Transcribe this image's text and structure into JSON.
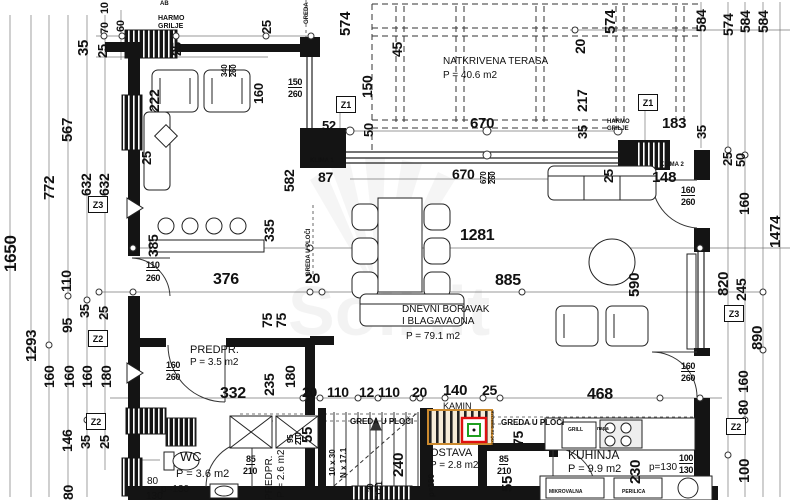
{
  "plan": {
    "title": "Ground floor plan",
    "watermark": "SolHit",
    "rooms": [
      {
        "name": "NATKRIVENA TERASA",
        "area": "P = 40.6 m2"
      },
      {
        "name": "DNEVNI BORAVAK I BLAGAVAONA",
        "area": "P = 79.1 m2"
      },
      {
        "name": "PREDPR.",
        "area": "P = 3.5 m2"
      },
      {
        "name": "WC",
        "area": "P = 3.6 m2"
      },
      {
        "name": "PREDPR.",
        "area": "P = 2.6 m2"
      },
      {
        "name": "OSTAVA",
        "area": "P = 2.8 m2"
      },
      {
        "name": "KUHINJA",
        "area": "P = 9.9 m2"
      }
    ],
    "markers": [
      {
        "t": "Z1",
        "x": 336,
        "y": 96
      },
      {
        "t": "Z1",
        "x": 638,
        "y": 94
      },
      {
        "t": "Z3",
        "x": 88,
        "y": 196
      },
      {
        "t": "Z2",
        "x": 88,
        "y": 330
      },
      {
        "t": "Z2",
        "x": 86,
        "y": 413
      },
      {
        "t": "Z3",
        "x": 724,
        "y": 305
      },
      {
        "t": "Z2",
        "x": 726,
        "y": 418
      }
    ],
    "labels": [
      {
        "t": "1650",
        "x": 2,
        "y": 272,
        "r": -90,
        "fs": 17
      },
      {
        "t": "1293",
        "x": 24,
        "y": 362,
        "r": -90,
        "fs": 15
      },
      {
        "t": "772",
        "x": 42,
        "y": 200,
        "r": -90,
        "fs": 15
      },
      {
        "t": "567",
        "x": 60,
        "y": 142,
        "r": -90,
        "fs": 15
      },
      {
        "t": "632",
        "x": 79,
        "y": 196,
        "r": -90,
        "fs": 14
      },
      {
        "t": "632",
        "x": 97,
        "y": 196,
        "r": -90,
        "fs": 14
      },
      {
        "t": "110",
        "x": 59,
        "y": 292,
        "r": -90,
        "fs": 14
      },
      {
        "t": "95",
        "x": 60,
        "y": 333,
        "r": -90,
        "fs": 14
      },
      {
        "t": "35",
        "x": 78,
        "y": 318,
        "r": -90,
        "fs": 13
      },
      {
        "t": "25",
        "x": 97,
        "y": 320,
        "r": -90,
        "fs": 13
      },
      {
        "t": "160",
        "x": 42,
        "y": 388,
        "r": -90,
        "fs": 14
      },
      {
        "t": "160",
        "x": 62,
        "y": 388,
        "r": -90,
        "fs": 14
      },
      {
        "t": "160",
        "x": 80,
        "y": 388,
        "r": -90,
        "fs": 14
      },
      {
        "t": "180",
        "x": 99,
        "y": 388,
        "r": -90,
        "fs": 14
      },
      {
        "t": "146",
        "x": 60,
        "y": 452,
        "r": -90,
        "fs": 14
      },
      {
        "t": "35",
        "x": 79,
        "y": 449,
        "r": -90,
        "fs": 13
      },
      {
        "t": "25",
        "x": 98,
        "y": 449,
        "r": -90,
        "fs": 13
      },
      {
        "t": "80",
        "x": 61,
        "y": 500,
        "r": -90,
        "fs": 14
      },
      {
        "t": "35",
        "x": 76,
        "y": 56,
        "r": -90,
        "fs": 15
      },
      {
        "t": "25",
        "x": 96,
        "y": 58,
        "r": -90,
        "fs": 13
      },
      {
        "t": "10",
        "x": 100,
        "y": 14,
        "r": -90,
        "fs": 11
      },
      {
        "t": "70",
        "x": 100,
        "y": 34,
        "r": -90,
        "fs": 11
      },
      {
        "t": "60",
        "x": 116,
        "y": 32,
        "r": -90,
        "fs": 11
      },
      {
        "t": "25",
        "x": 170,
        "y": 56,
        "r": -90,
        "fs": 13
      },
      {
        "t": "25",
        "x": 260,
        "y": 34,
        "r": -90,
        "fs": 13
      },
      {
        "t": "AB",
        "x": 160,
        "y": 1,
        "fs": 6,
        "c": "tiny"
      },
      {
        "t": "HARMO",
        "x": 158,
        "y": 15,
        "fs": 7,
        "c": "tiny"
      },
      {
        "t": "GRILJE",
        "x": 158,
        "y": 23,
        "fs": 7,
        "c": "tiny"
      },
      {
        "t": "GREDA",
        "x": 304,
        "y": 24,
        "r": -90,
        "fs": 6,
        "c": "tiny"
      },
      {
        "t": "574",
        "x": 338,
        "y": 36,
        "r": -90,
        "fs": 15
      },
      {
        "t": "45",
        "x": 390,
        "y": 57,
        "r": -90,
        "fs": 14
      },
      {
        "t": "150",
        "x": 360,
        "y": 98,
        "r": -90,
        "fs": 14
      },
      {
        "t": "50",
        "x": 362,
        "y": 137,
        "r": -90,
        "fs": 13
      },
      {
        "t": "150",
        "x": 288,
        "y": 78,
        "fs": 9,
        "c": "fracu"
      },
      {
        "t": "260",
        "x": 288,
        "y": 90,
        "fs": 9,
        "c": "frac"
      },
      {
        "t": "582",
        "x": 282,
        "y": 192,
        "r": -90,
        "fs": 14
      },
      {
        "t": "87",
        "x": 318,
        "y": 170,
        "fs": 14
      },
      {
        "t": "52",
        "x": 322,
        "y": 119,
        "fs": 13
      },
      {
        "t": "670",
        "x": 470,
        "y": 116,
        "fs": 15
      },
      {
        "t": "670",
        "x": 452,
        "y": 167,
        "fs": 14
      },
      {
        "t": "670",
        "x": 480,
        "y": 184,
        "r": -90,
        "fs": 8,
        "c": "fracu"
      },
      {
        "t": "260",
        "x": 489,
        "y": 184,
        "r": -90,
        "fs": 8,
        "c": "frac"
      },
      {
        "t": "KLIMA 1",
        "x": 310,
        "y": 158,
        "fs": 6,
        "c": "tiny"
      },
      {
        "t": "20",
        "x": 573,
        "y": 54,
        "r": -90,
        "fs": 14
      },
      {
        "t": "574",
        "x": 603,
        "y": 34,
        "r": -90,
        "fs": 15
      },
      {
        "t": "217",
        "x": 575,
        "y": 112,
        "r": -90,
        "fs": 14
      },
      {
        "t": "35",
        "x": 576,
        "y": 139,
        "r": -90,
        "fs": 13
      },
      {
        "t": "183",
        "x": 662,
        "y": 116,
        "fs": 15
      },
      {
        "t": "HARMO",
        "x": 607,
        "y": 119,
        "fs": 6,
        "c": "tiny"
      },
      {
        "t": "GRILJE",
        "x": 607,
        "y": 126,
        "fs": 6,
        "c": "tiny"
      },
      {
        "t": "35",
        "x": 695,
        "y": 139,
        "r": -90,
        "fs": 13
      },
      {
        "t": "584",
        "x": 694,
        "y": 32,
        "r": -90,
        "fs": 14
      },
      {
        "t": "574",
        "x": 721,
        "y": 36,
        "r": -90,
        "fs": 14
      },
      {
        "t": "584",
        "x": 738,
        "y": 33,
        "r": -90,
        "fs": 14
      },
      {
        "t": "584",
        "x": 756,
        "y": 33,
        "r": -90,
        "fs": 14
      },
      {
        "t": "KLIMA 2",
        "x": 660,
        "y": 162,
        "fs": 6,
        "c": "tiny"
      },
      {
        "t": "148",
        "x": 652,
        "y": 170,
        "fs": 15
      },
      {
        "t": "25",
        "x": 602,
        "y": 183,
        "r": -90,
        "fs": 13
      },
      {
        "t": "25",
        "x": 721,
        "y": 166,
        "r": -90,
        "fs": 13
      },
      {
        "t": "50",
        "x": 734,
        "y": 167,
        "r": -90,
        "fs": 13
      },
      {
        "t": "160",
        "x": 737,
        "y": 215,
        "r": -90,
        "fs": 14
      },
      {
        "t": "1474",
        "x": 768,
        "y": 248,
        "r": -90,
        "fs": 15
      },
      {
        "t": "160",
        "x": 681,
        "y": 186,
        "fs": 9,
        "c": "fracu"
      },
      {
        "t": "260",
        "x": 681,
        "y": 198,
        "fs": 9,
        "c": "frac"
      },
      {
        "t": "NATKRIVENA TERASA",
        "x": 443,
        "y": 57,
        "fs": 10,
        "c": "room",
        "n": "room-label-terasa"
      },
      {
        "t": "P = 40.6 m2",
        "x": 443,
        "y": 71,
        "fs": 10,
        "c": "room"
      },
      {
        "t": "335",
        "x": 262,
        "y": 242,
        "r": -90,
        "fs": 14
      },
      {
        "t": "385",
        "x": 146,
        "y": 257,
        "r": -90,
        "fs": 14
      },
      {
        "t": "110",
        "x": 146,
        "y": 261,
        "fs": 9,
        "c": "fracu"
      },
      {
        "t": "260",
        "x": 146,
        "y": 274,
        "fs": 9,
        "c": "frac"
      },
      {
        "t": "376",
        "x": 213,
        "y": 272,
        "fs": 16
      },
      {
        "t": "1281",
        "x": 460,
        "y": 228,
        "fs": 16
      },
      {
        "t": "885",
        "x": 495,
        "y": 273,
        "fs": 16
      },
      {
        "t": "590",
        "x": 627,
        "y": 297,
        "r": -90,
        "fs": 15
      },
      {
        "t": "20",
        "x": 305,
        "y": 271,
        "fs": 14
      },
      {
        "t": "75",
        "x": 260,
        "y": 328,
        "r": -90,
        "fs": 14
      },
      {
        "t": "75",
        "x": 274,
        "y": 328,
        "r": -90,
        "fs": 14
      },
      {
        "t": "DNEVNI BORAVAK",
        "x": 402,
        "y": 305,
        "fs": 10,
        "c": "room",
        "n": "room-label-dnevni"
      },
      {
        "t": "I BLAGAVAONA",
        "x": 402,
        "y": 317,
        "fs": 10,
        "c": "room"
      },
      {
        "t": "P = 79.1 m2",
        "x": 406,
        "y": 332,
        "fs": 10,
        "c": "room"
      },
      {
        "t": "GREDA U PLOČI",
        "x": 306,
        "y": 276,
        "r": -90,
        "fs": 6,
        "c": "tiny"
      },
      {
        "t": "222",
        "x": 147,
        "y": 112,
        "r": -90,
        "fs": 14
      },
      {
        "t": "340",
        "x": 221,
        "y": 77,
        "r": -90,
        "fs": 8,
        "c": "fracu"
      },
      {
        "t": "260",
        "x": 230,
        "y": 77,
        "r": -90,
        "fs": 8,
        "c": "frac"
      },
      {
        "t": "160",
        "x": 252,
        "y": 104,
        "r": -90,
        "fs": 13
      },
      {
        "t": "25",
        "x": 140,
        "y": 165,
        "r": -90,
        "fs": 13
      },
      {
        "t": "820",
        "x": 716,
        "y": 296,
        "r": -90,
        "fs": 15
      },
      {
        "t": "245",
        "x": 734,
        "y": 301,
        "r": -90,
        "fs": 14
      },
      {
        "t": "890",
        "x": 750,
        "y": 350,
        "r": -90,
        "fs": 15
      },
      {
        "t": "160",
        "x": 736,
        "y": 393,
        "r": -90,
        "fs": 14
      },
      {
        "t": "80",
        "x": 736,
        "y": 415,
        "r": -90,
        "fs": 14
      },
      {
        "t": "100",
        "x": 737,
        "y": 483,
        "r": -90,
        "fs": 15
      },
      {
        "t": "160",
        "x": 681,
        "y": 362,
        "fs": 9,
        "c": "fracu"
      },
      {
        "t": "260",
        "x": 681,
        "y": 374,
        "fs": 9,
        "c": "frac"
      },
      {
        "t": "PREDPR.",
        "x": 190,
        "y": 345,
        "fs": 11,
        "c": "room",
        "n": "room-label-predpr"
      },
      {
        "t": "P = 3.5 m2",
        "x": 190,
        "y": 358,
        "fs": 10,
        "c": "room"
      },
      {
        "t": "160",
        "x": 166,
        "y": 361,
        "fs": 9,
        "c": "fracu"
      },
      {
        "t": "260",
        "x": 166,
        "y": 373,
        "fs": 9,
        "c": "frac"
      },
      {
        "t": "332",
        "x": 220,
        "y": 386,
        "fs": 16
      },
      {
        "t": "235",
        "x": 262,
        "y": 396,
        "r": -90,
        "fs": 14
      },
      {
        "t": "180",
        "x": 283,
        "y": 388,
        "r": -90,
        "fs": 14
      },
      {
        "t": "20",
        "x": 302,
        "y": 385,
        "fs": 14
      },
      {
        "t": "110",
        "x": 327,
        "y": 385,
        "fs": 14
      },
      {
        "t": "12",
        "x": 359,
        "y": 385,
        "fs": 14
      },
      {
        "t": "110",
        "x": 378,
        "y": 385,
        "fs": 14
      },
      {
        "t": "20",
        "x": 412,
        "y": 385,
        "fs": 14
      },
      {
        "t": "140",
        "x": 443,
        "y": 383,
        "fs": 15
      },
      {
        "t": "25",
        "x": 482,
        "y": 383,
        "fs": 14
      },
      {
        "t": "468",
        "x": 587,
        "y": 387,
        "fs": 16
      },
      {
        "t": "KAMIN",
        "x": 443,
        "y": 402,
        "fs": 9,
        "c": "room",
        "n": "room-label-kamin"
      },
      {
        "t": "GREDA U PLOČI",
        "x": 350,
        "y": 418,
        "fs": 8,
        "c": "tiny"
      },
      {
        "t": "GREDA U PLOČI",
        "x": 501,
        "y": 419,
        "fs": 8,
        "c": "tiny"
      },
      {
        "t": "55",
        "x": 300,
        "y": 443,
        "r": -90,
        "fs": 15
      },
      {
        "t": "95",
        "x": 287,
        "y": 443,
        "r": -90,
        "fs": 8,
        "c": "fracu"
      },
      {
        "t": "210",
        "x": 295,
        "y": 445,
        "r": -90,
        "fs": 8,
        "c": "frac"
      },
      {
        "t": "WC",
        "x": 180,
        "y": 450,
        "fs": 13,
        "c": "room",
        "n": "room-label-wc"
      },
      {
        "t": "P = 3.6 m2",
        "x": 176,
        "y": 469,
        "fs": 11,
        "c": "room"
      },
      {
        "t": "80",
        "x": 147,
        "y": 477,
        "fs": 10,
        "c": "room"
      },
      {
        "t": "p=130",
        "x": 161,
        "y": 485,
        "fs": 10,
        "c": "room"
      },
      {
        "t": "130",
        "x": 146,
        "y": 492,
        "fs": 10,
        "c": "room"
      },
      {
        "t": "85",
        "x": 246,
        "y": 455,
        "fs": 9,
        "c": "fracu"
      },
      {
        "t": "210",
        "x": 243,
        "y": 467,
        "fs": 9,
        "c": "frac"
      },
      {
        "t": "PREDPR.",
        "x": 265,
        "y": 500,
        "r": -90,
        "fs": 10,
        "c": "room",
        "n": "room-label-predpr2"
      },
      {
        "t": "P = 2.6 m2",
        "x": 277,
        "y": 498,
        "r": -90,
        "fs": 10,
        "c": "room"
      },
      {
        "t": "10 x 30",
        "x": 329,
        "y": 476,
        "r": -90,
        "fs": 8,
        "c": "tiny"
      },
      {
        "t": "N x 17.1",
        "x": 340,
        "y": 478,
        "r": -90,
        "fs": 8,
        "c": "tiny"
      },
      {
        "t": "240",
        "x": 391,
        "y": 477,
        "r": -90,
        "fs": 15
      },
      {
        "t": "30",
        "x": 367,
        "y": 492,
        "r": -90,
        "fs": 8,
        "c": "fracu"
      },
      {
        "t": "17.1",
        "x": 376,
        "y": 496,
        "r": -90,
        "fs": 8,
        "c": "frac"
      },
      {
        "t": "OSTAVA",
        "x": 430,
        "y": 448,
        "fs": 11,
        "c": "room",
        "n": "room-label-ostava"
      },
      {
        "t": "P = 2.8 m2",
        "x": 430,
        "y": 461,
        "fs": 10,
        "c": "room"
      },
      {
        "t": "85",
        "x": 499,
        "y": 455,
        "fs": 9,
        "c": "fracu"
      },
      {
        "t": "210",
        "x": 497,
        "y": 467,
        "fs": 9,
        "c": "frac"
      },
      {
        "t": "p=130",
        "x": 428,
        "y": 497,
        "r": -90,
        "fs": 8,
        "c": "tiny"
      },
      {
        "t": "75",
        "x": 511,
        "y": 446,
        "r": -90,
        "fs": 14
      },
      {
        "t": "55",
        "x": 500,
        "y": 492,
        "r": -90,
        "fs": 15
      },
      {
        "t": "PLOČ ZA DIMNJAK",
        "x": 491,
        "y": 447,
        "r": -90,
        "fs": 4,
        "c": "tiny"
      },
      {
        "t": "KUHINJA",
        "x": 568,
        "y": 449,
        "fs": 12,
        "c": "room",
        "n": "room-label-kuhinja"
      },
      {
        "t": "P = 9.9 m2",
        "x": 568,
        "y": 464,
        "fs": 11,
        "c": "room"
      },
      {
        "t": "230",
        "x": 628,
        "y": 484,
        "r": -90,
        "fs": 15
      },
      {
        "t": "p=130",
        "x": 649,
        "y": 463,
        "fs": 10,
        "c": "room"
      },
      {
        "t": "100",
        "x": 679,
        "y": 454,
        "fs": 9,
        "c": "fracu"
      },
      {
        "t": "130",
        "x": 679,
        "y": 466,
        "fs": 9,
        "c": "frac"
      },
      {
        "t": "GRILL",
        "x": 568,
        "y": 428,
        "fs": 5,
        "c": "tiny"
      },
      {
        "t": "napa",
        "x": 597,
        "y": 427,
        "fs": 5,
        "c": "tiny"
      },
      {
        "t": "MIKROVALNA",
        "x": 549,
        "y": 490,
        "fs": 5,
        "c": "tiny"
      },
      {
        "t": "PERILICA",
        "x": 622,
        "y": 490,
        "fs": 5,
        "c": "tiny"
      }
    ]
  }
}
